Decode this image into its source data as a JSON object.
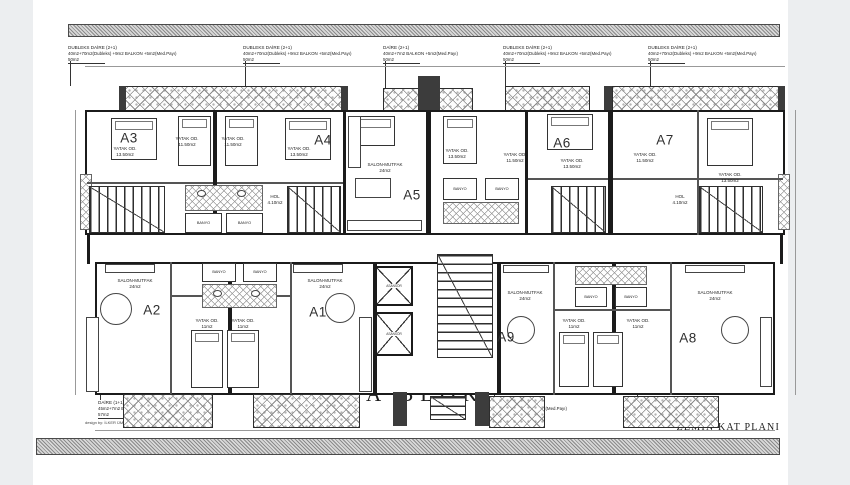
{
  "sheet": {
    "block_title": "A BLOK",
    "plan_title": "ZEMİN KAT PLANI",
    "area_net": "E: 482m2",
    "area_gross": "T: 532m2",
    "credit": "design by: İLKER ÜMİT KARADURMAN"
  },
  "colors": {
    "wall": "#1b1b1b",
    "hatch_gray": "#8b8b8b",
    "paper": "#ffffff"
  },
  "units": [
    "A3",
    "A4",
    "A5",
    "A6",
    "A7",
    "A2",
    "A1",
    "A9",
    "A8"
  ],
  "core": {
    "elevator": "ASANSÖR"
  },
  "annotations": {
    "top": [
      {
        "l1": "DUBLEKS DAİRE (2+1)",
        "l2": "40m2+70m2(Dubleks) +9m2 BALKON +5m2(Med.Payı)",
        "l3": "50m2"
      },
      {
        "l1": "DUBLEKS DAİRE (2+1)",
        "l2": "40m2+70m2(Dubleks) +9m2 BALKON +5m2(Med.Payı)",
        "l3": "50m2"
      },
      {
        "l1": "DAİRE (2+1)",
        "l2": "40m2+7m2 BALKON +5m2(Med.Payı)",
        "l3": "50m2"
      },
      {
        "l1": "DUBLEKS DAİRE (2+1)",
        "l2": "40m2+70m2(Dubleks) +9m2 BALKON +5m2(Med.Payı)",
        "l3": "50m2"
      },
      {
        "l1": "DUBLEKS DAİRE (2+1)",
        "l2": "40m2+70m2(Dubleks) +9m2 BALKON +5m2(Med.Payı)",
        "l3": "50m2"
      }
    ],
    "bottom": [
      {
        "l1": "DAİRE (1+1)",
        "l2": "45m2+7m2 BALKON +5m2(Med.Payı)",
        "l3": "57m2"
      },
      {
        "l1": "DAİRE (1+1)",
        "l2": "45m2+7m2 BALKON +5m2(Med.Payı)",
        "l3": "57m2"
      },
      {
        "l1": "DAİRE (1+1)",
        "l2": "45m2+7m2 BALKON +5m2(Med.Payı)",
        "l3": "57m2"
      },
      {
        "l1": "DAİRE (1+1)",
        "l2": "45m2+7m2 BALKON +5m2(Med.Payı)",
        "l3": "57m2"
      }
    ]
  },
  "rooms": [
    {
      "n": "YATAK OD.",
      "a": "13.50m2"
    },
    {
      "n": "YATAK OD.",
      "a": "11.50m2"
    },
    {
      "n": "YATAK OD.",
      "a": "11.50m2"
    },
    {
      "n": "YATAK OD.",
      "a": "13.50m2"
    },
    {
      "n": "SALON-MUTFAK",
      "a": "24m2"
    },
    {
      "n": "YATAK OD.",
      "a": "13.50m2"
    },
    {
      "n": "YATAK OD.",
      "a": "11.50m2"
    },
    {
      "n": "YATAK OD.",
      "a": "13.50m2"
    },
    {
      "n": "YATAK OD.",
      "a": "11.50m2"
    },
    {
      "n": "YATAK OD.",
      "a": "13.50m2"
    },
    {
      "n": "SALON-MUTFAK",
      "a": "24m2"
    },
    {
      "n": "SALON-MUTFAK",
      "a": "24m2"
    },
    {
      "n": "YATAK OD.",
      "a": "11m2"
    },
    {
      "n": "YATAK OD.",
      "a": "11m2"
    },
    {
      "n": "SALON-MUTFAK",
      "a": "24m2"
    },
    {
      "n": "SALON-MUTFAK",
      "a": "24m2"
    },
    {
      "n": "YATAK OD.",
      "a": "11m2"
    },
    {
      "n": "YATAK OD.",
      "a": "11m2"
    },
    {
      "n": "BANYO",
      "a": "4m2"
    },
    {
      "n": "BANYO",
      "a": "4m2"
    },
    {
      "n": "BANYO",
      "a": "4m2"
    },
    {
      "n": "BANYO",
      "a": "4m2"
    },
    {
      "n": "BANYO",
      "a": "4m2"
    },
    {
      "n": "BANYO",
      "a": "4m2"
    },
    {
      "n": "BANYO",
      "a": "4m2"
    },
    {
      "n": "BANYO",
      "a": "4m2"
    },
    {
      "n": "HOL",
      "a": "4.10m2"
    },
    {
      "n": "HOL",
      "a": "4.10m2"
    }
  ]
}
